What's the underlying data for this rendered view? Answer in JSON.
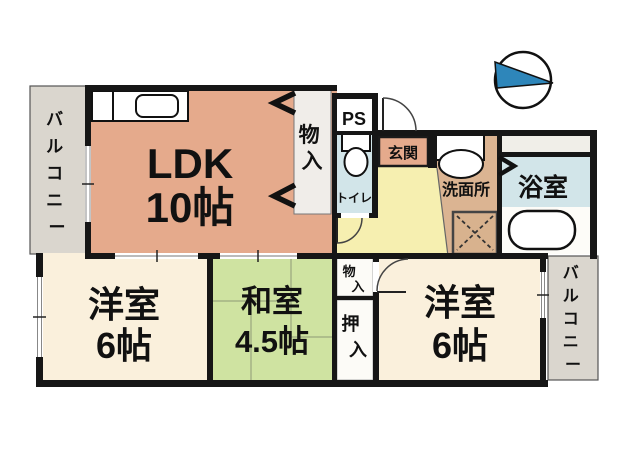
{
  "floorplan": {
    "type": "apartment-floor-plan",
    "compass": {
      "shape": "circle-with-triangle",
      "triangle_color": "#2e86ba"
    },
    "rooms": {
      "ldk": {
        "name": "LDK",
        "size": "10帖",
        "color": "#e5aa8c"
      },
      "western_left": {
        "name": "洋室",
        "size": "6帖",
        "color": "#faf0dc"
      },
      "japanese": {
        "name": "和室",
        "size": "4.5帖",
        "color": "#cfe3a1"
      },
      "western_right": {
        "name": "洋室",
        "size": "6帖",
        "color": "#faf0dc"
      },
      "toilet": {
        "name": "トイレ",
        "color": "#d2e5e9"
      },
      "washroom": {
        "name": "洗面所",
        "color": "#dbb492"
      },
      "bathroom": {
        "name": "浴室",
        "color": "#d2e5e9"
      },
      "entrance": {
        "name": "玄関",
        "color": "#e5aa8c"
      },
      "hallway": {
        "color": "#f6efb0"
      },
      "ps": {
        "name": "PS"
      },
      "closet_ldk": {
        "name": "物入",
        "chars": [
          "物",
          "入"
        ]
      },
      "closet_small": {
        "name": "物入",
        "chars": [
          "物",
          "入"
        ]
      },
      "oshiire": {
        "name": "押入",
        "chars": [
          "押",
          "入"
        ]
      },
      "balcony_left": {
        "name": "バルコニー",
        "chars": [
          "バ",
          "ル",
          "コ",
          "ニ",
          "ー"
        ],
        "color": "#dad6ce"
      },
      "balcony_right": {
        "name": "バルコニー",
        "chars": [
          "バ",
          "ル",
          "コ",
          "ニ",
          "ー"
        ],
        "color": "#dad6ce"
      }
    },
    "fixtures": [
      "kitchen-counter-with-sink",
      "toilet-bowl",
      "washbasin",
      "washing-machine-pan",
      "bathtub"
    ],
    "wall_color": "#161616"
  }
}
